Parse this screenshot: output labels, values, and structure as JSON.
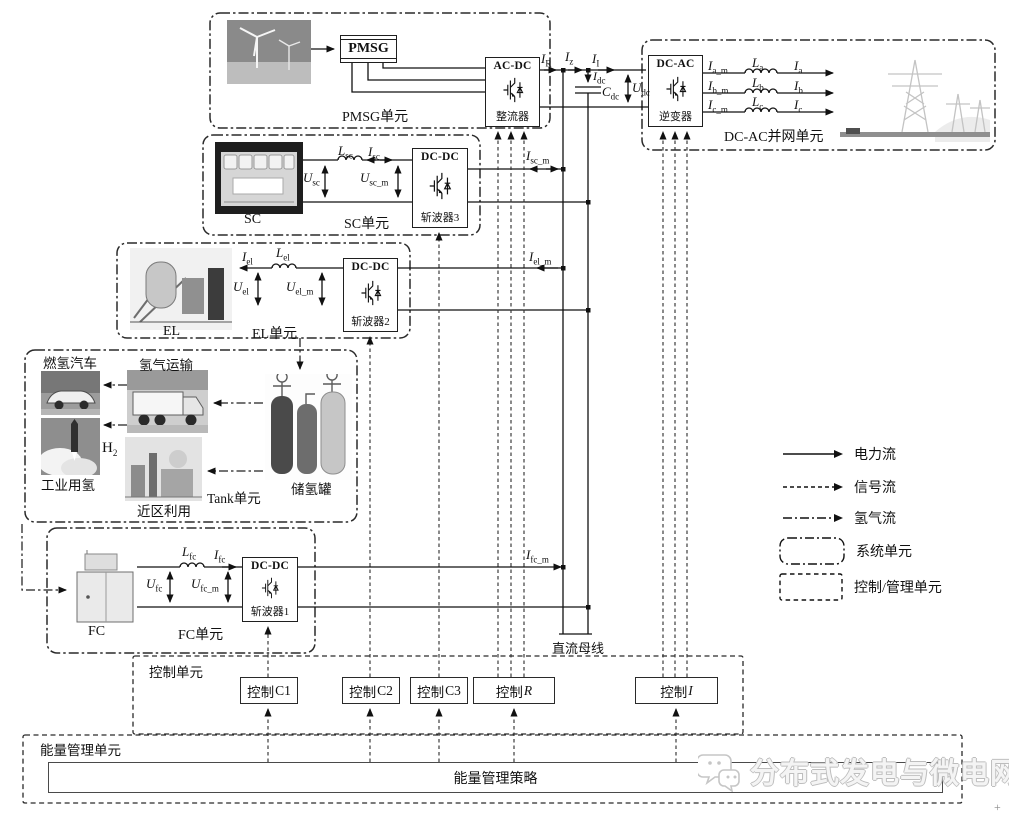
{
  "diagram": {
    "dc_bus_label": "直流母线",
    "watermark": "分布式发电与微电网",
    "corner_mark": "+"
  },
  "pmsg_unit": {
    "label": "PMSG单元",
    "generator": "PMSG",
    "converter": {
      "type": "AC-DC",
      "name": "整流器"
    }
  },
  "grid_unit": {
    "label": "DC-AC并网单元",
    "converter": {
      "type": "DC-AC",
      "name": "逆变器"
    }
  },
  "sc_unit": {
    "label": "SC单元",
    "source": "SC",
    "converter": {
      "type": "DC-DC",
      "name": "斩波器3"
    }
  },
  "el_unit": {
    "label": "EL单元",
    "source": "EL",
    "converter": {
      "type": "DC-DC",
      "name": "斩波器2"
    }
  },
  "fc_unit": {
    "label": "FC单元",
    "source": "FC",
    "converter": {
      "type": "DC-DC",
      "name": "斩波器1"
    }
  },
  "tank_unit": {
    "label": "Tank单元",
    "car": "燃氢汽车",
    "transport": "氢气运输",
    "industry": "工业用氢",
    "local": "近区利用",
    "tank": "储氢罐"
  },
  "control_unit": {
    "label": "控制单元",
    "boxes": [
      {
        "cn": "控制",
        "var": "C1"
      },
      {
        "cn": "控制",
        "var": "C2"
      },
      {
        "cn": "控制",
        "var": "C3"
      },
      {
        "cn": "控制",
        "var": "R"
      },
      {
        "cn": "控制",
        "var": "I"
      }
    ]
  },
  "ems_unit": {
    "label": "能量管理单元",
    "strategy": "能量管理策略"
  },
  "legend": {
    "power": "电力流",
    "signal": "信号流",
    "hydrogen": "氢气流",
    "system_unit": "系统单元",
    "control_unit": "控制/管理单元"
  },
  "sub_labels": {
    "i_r": {
      "base": "I",
      "sub": "R"
    },
    "i_z": {
      "base": "I",
      "sub": "z"
    },
    "i_inv": {
      "base": "I",
      "sub": "I"
    },
    "i_dc": {
      "base": "I",
      "sub": "dc"
    },
    "c_dc": {
      "base": "C",
      "sub": "dc"
    },
    "u_dc": {
      "base": "U",
      "sub": "dc"
    },
    "i_a_m": {
      "base": "I",
      "sub": "a_m"
    },
    "l_a": {
      "base": "L",
      "sub": "a"
    },
    "i_a": {
      "base": "I",
      "sub": "a"
    },
    "i_b_m": {
      "base": "I",
      "sub": "b_m"
    },
    "l_b": {
      "base": "L",
      "sub": "b"
    },
    "i_b": {
      "base": "I",
      "sub": "b"
    },
    "i_c_m": {
      "base": "I",
      "sub": "c_m"
    },
    "l_c": {
      "base": "L",
      "sub": "c"
    },
    "i_c": {
      "base": "I",
      "sub": "c"
    },
    "l_sc": {
      "base": "L",
      "sub": "sc"
    },
    "i_sc": {
      "base": "I",
      "sub": "sc"
    },
    "u_sc": {
      "base": "U",
      "sub": "sc"
    },
    "u_sc_m": {
      "base": "U",
      "sub": "sc_m"
    },
    "i_sc_m": {
      "base": "I",
      "sub": "sc_m"
    },
    "i_el": {
      "base": "I",
      "sub": "el"
    },
    "l_el": {
      "base": "L",
      "sub": "el"
    },
    "u_el": {
      "base": "U",
      "sub": "el"
    },
    "u_el_m": {
      "base": "U",
      "sub": "el_m"
    },
    "i_el_m": {
      "base": "I",
      "sub": "el_m"
    },
    "l_fc": {
      "base": "L",
      "sub": "fc"
    },
    "i_fc": {
      "base": "I",
      "sub": "fc"
    },
    "u_fc": {
      "base": "U",
      "sub": "fc"
    },
    "u_fc_m": {
      "base": "U",
      "sub": "fc_m"
    },
    "i_fc_m": {
      "base": "I",
      "sub": "fc_m"
    },
    "h2": {
      "base": "H",
      "sub": "2"
    }
  }
}
